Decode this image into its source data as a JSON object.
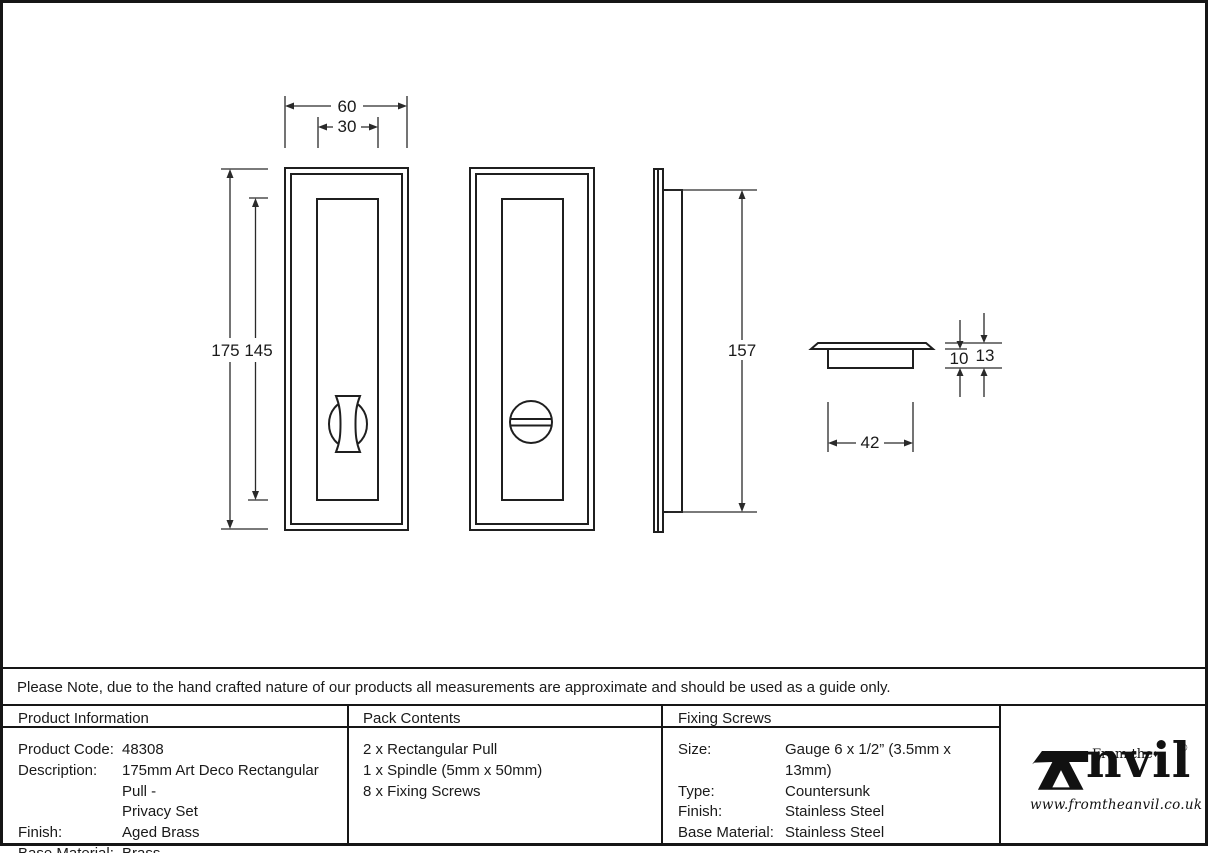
{
  "note": {
    "text": "Please Note, due to the hand crafted nature of our products all measurements are approximate and should be used as a guide only."
  },
  "drawing": {
    "dims": {
      "front_width": "60",
      "panel_width": "30",
      "front_heights": "175 145",
      "side_height": "157",
      "cup_width": "42",
      "cup_depth": "10",
      "total_depth": "13"
    }
  },
  "tables": {
    "product_information": {
      "header": "Product Information",
      "rows": [
        {
          "label": "Product Code:",
          "value": "48308"
        },
        {
          "label": "Description:",
          "value": "175mm Art Deco Rectangular Pull -"
        },
        {
          "label": "",
          "value": "Privacy Set"
        },
        {
          "label": "Finish:",
          "value": "Aged Brass"
        },
        {
          "label": "Base Material:",
          "value": "Brass"
        }
      ]
    },
    "pack_contents": {
      "header": "Pack Contents",
      "items": [
        "2 x Rectangular Pull",
        "1 x Spindle (5mm x 50mm)",
        "8 x Fixing Screws"
      ]
    },
    "fixing_screws": {
      "header": "Fixing Screws",
      "rows": [
        {
          "label": "Size:",
          "value": "Gauge 6 x 1/2” (3.5mm x 13mm)"
        },
        {
          "label": "Type:",
          "value": "Countersunk"
        },
        {
          "label": "Finish:",
          "value": "Stainless Steel"
        },
        {
          "label": "Base Material:",
          "value": "Stainless Steel"
        }
      ]
    }
  },
  "logo": {
    "from_the": "From the",
    "diamond": "♦",
    "wordmark": "nvil",
    "registered": "®",
    "url": "www.fromtheanvil.co.uk"
  }
}
